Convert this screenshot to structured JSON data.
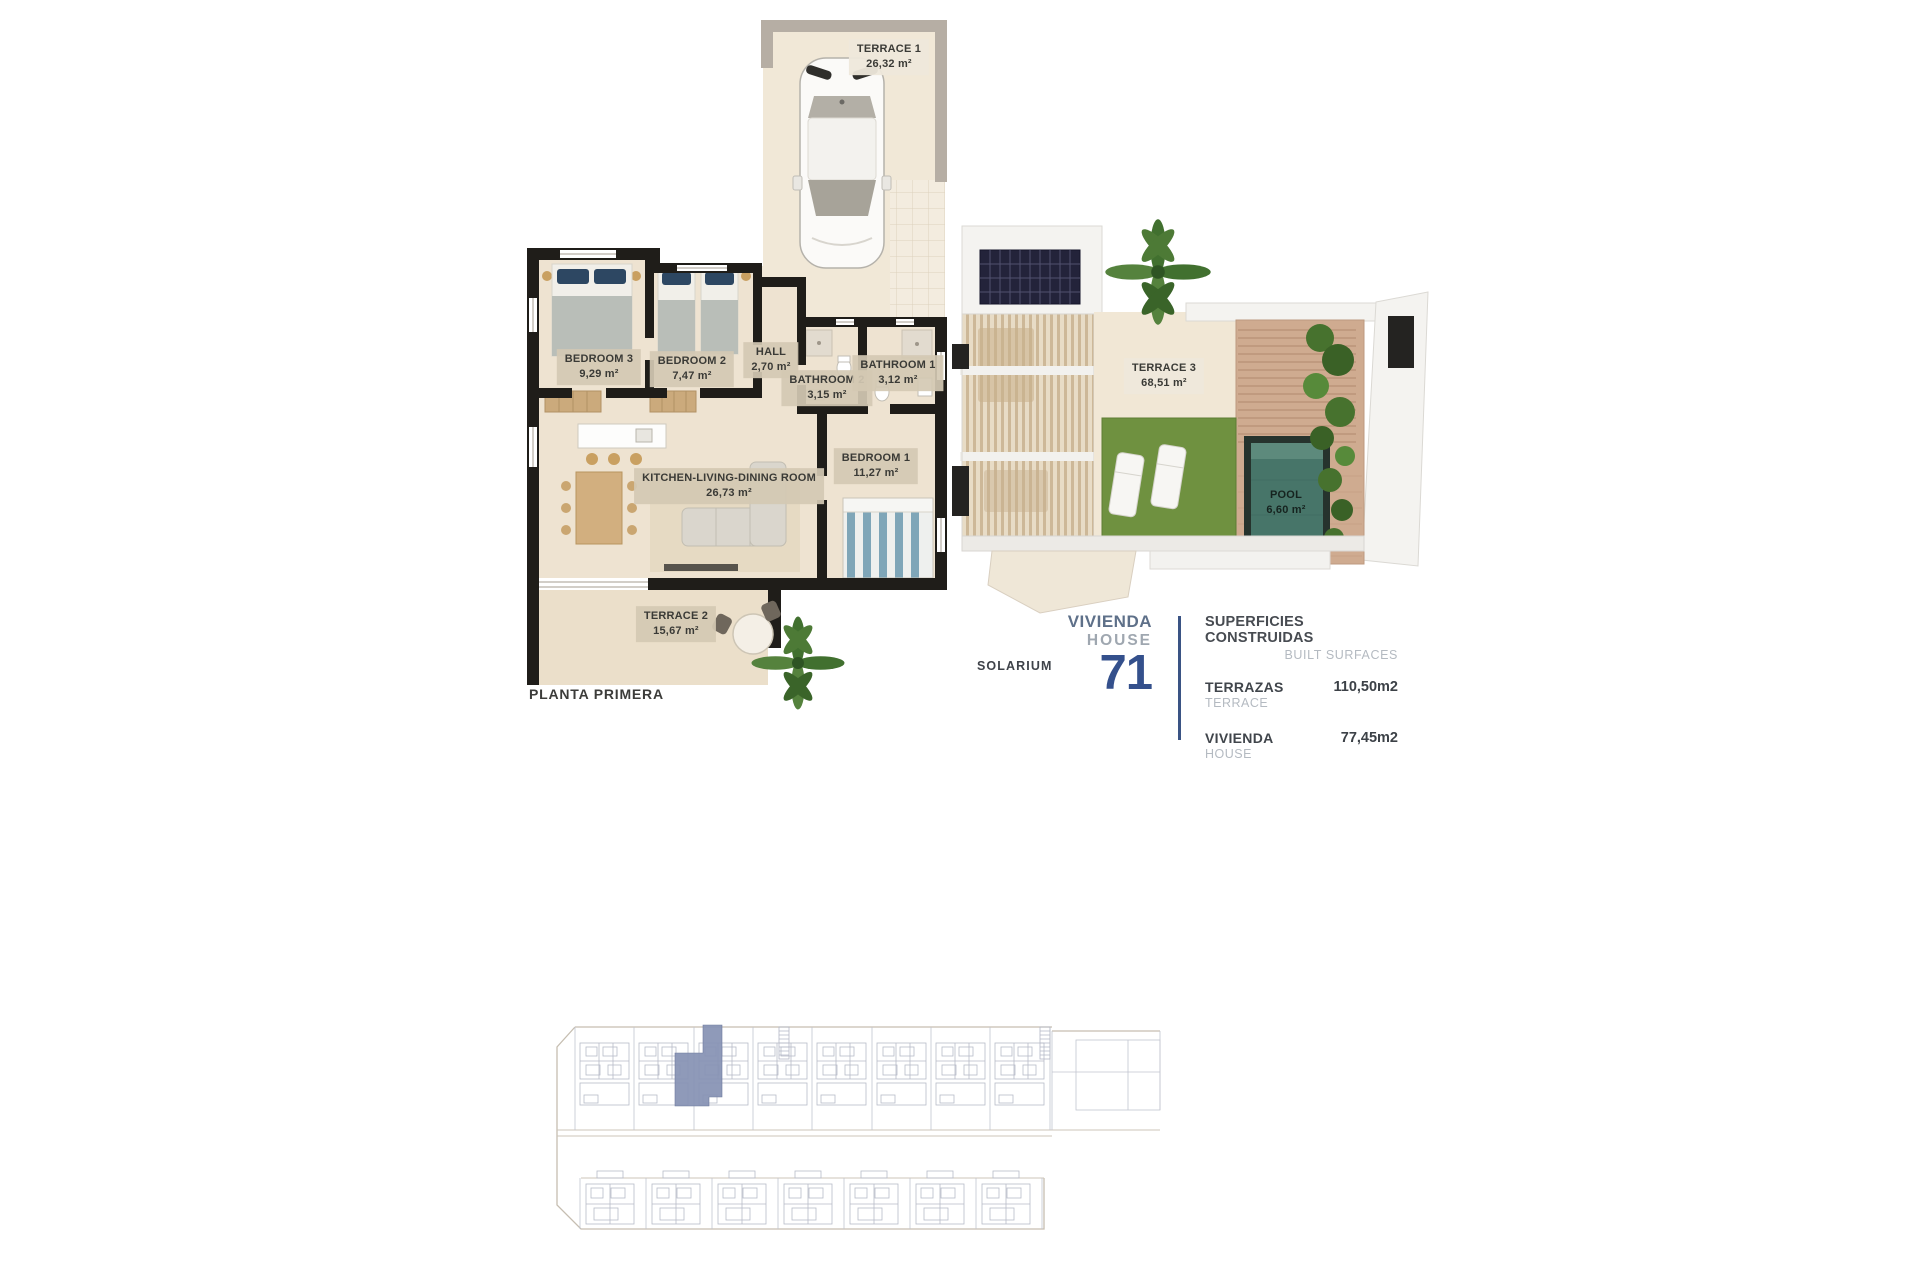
{
  "plan_first_floor": {
    "title": "PLANTA PRIMERA",
    "rooms": [
      {
        "name": "TERRACE 1",
        "area": "26,32 m²"
      },
      {
        "name": "BEDROOM 3",
        "area": "9,29 m²"
      },
      {
        "name": "BEDROOM 2",
        "area": "7,47 m²"
      },
      {
        "name": "HALL",
        "area": "2,70 m²"
      },
      {
        "name": "BATHROOM 2",
        "area": "3,15 m²"
      },
      {
        "name": "BATHROOM 1",
        "area": "3,12 m²"
      },
      {
        "name": "BEDROOM 1",
        "area": "11,27 m²"
      },
      {
        "name": "KITCHEN-LIVING-DINING ROOM",
        "area": "26,73 m²"
      },
      {
        "name": "TERRACE 2",
        "area": "15,67 m²"
      }
    ]
  },
  "plan_solarium": {
    "title": "SOLARIUM",
    "rooms": [
      {
        "name": "TERRACE 3",
        "area": "68,51 m²"
      },
      {
        "name": "POOL",
        "area": "6,60 m²"
      }
    ]
  },
  "unit_info": {
    "name_es": "VIVIENDA",
    "name_en": "HOUSE",
    "number": "71"
  },
  "surfaces": {
    "title_es": "SUPERFICIES CONSTRUIDAS",
    "title_en": "BUILT SURFACES",
    "rows": [
      {
        "label_es": "TERRAZAS",
        "label_en": "TERRACE",
        "value": "110,50m2"
      },
      {
        "label_es": "VIVIENDA",
        "label_en": "HOUSE",
        "value": "77,45m2"
      }
    ]
  },
  "colors": {
    "accent_navy": "#34508c",
    "slate_blue": "#5e7089",
    "muted_gray": "#9fa7b0",
    "site_highlight": "#8691b3",
    "pool_water": "#477569",
    "grass": "#6f9140",
    "wall_black": "#1f1d19",
    "floor_beige": "#eee3d1"
  }
}
